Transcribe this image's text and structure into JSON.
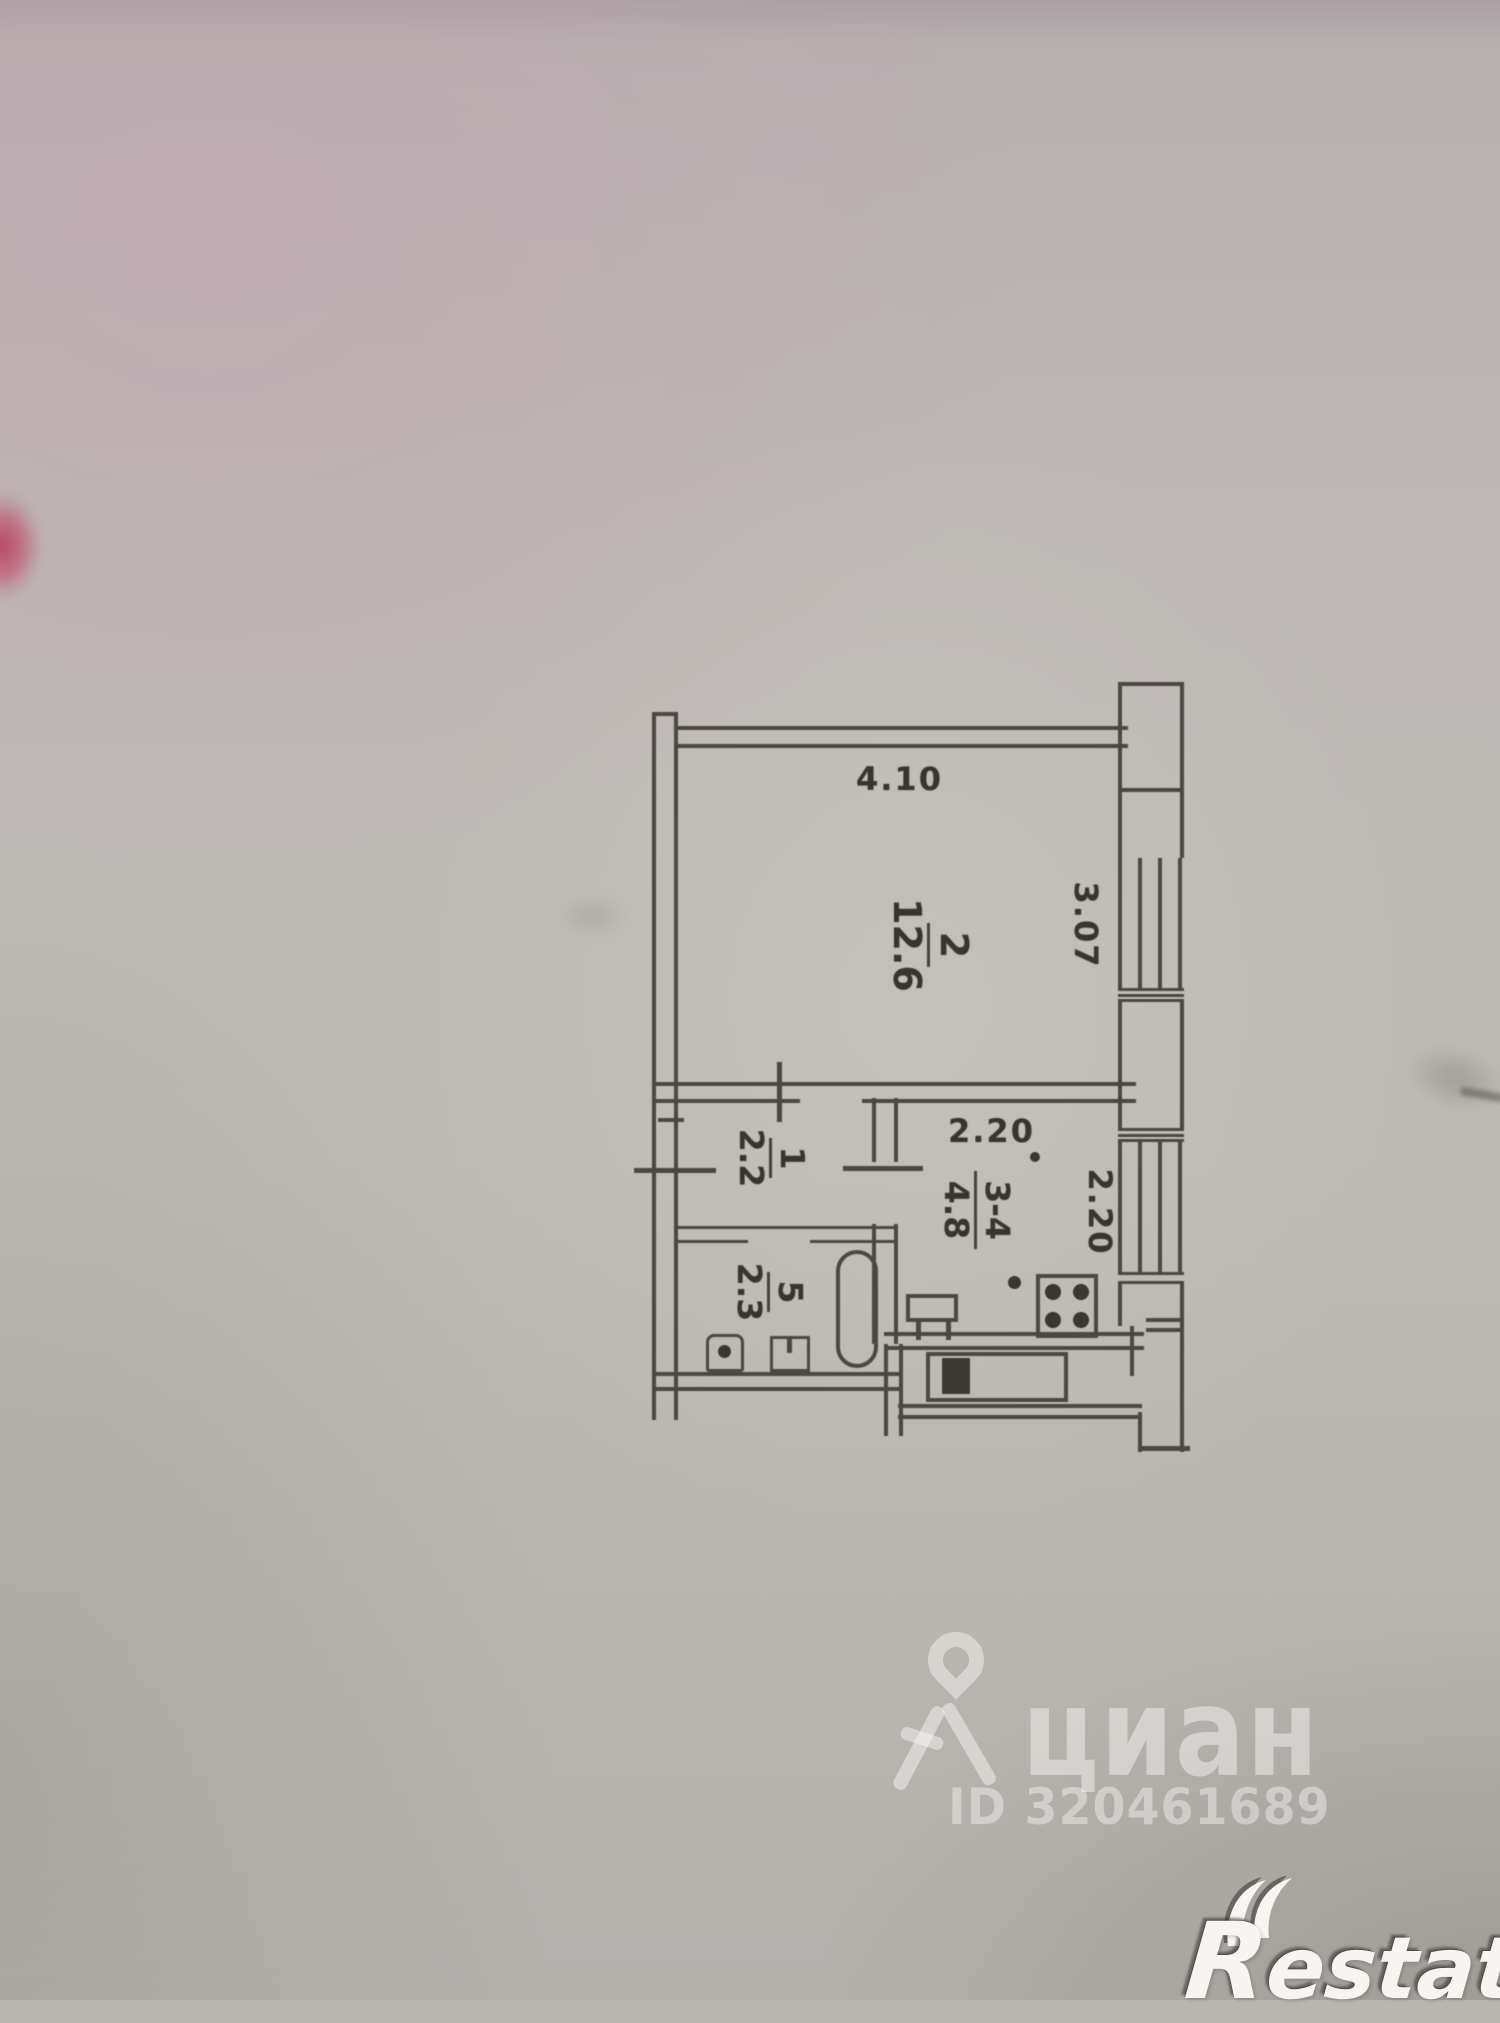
{
  "floor_plan": {
    "dimensions": {
      "top": "4.10",
      "right": "3.07",
      "kitchen_top": "2.20",
      "kitchen_right": "2.20"
    },
    "rooms": {
      "living": {
        "number": "2",
        "area": "12.6"
      },
      "hallway": {
        "number": "1",
        "area": "2.2"
      },
      "kitchen": {
        "number": "3-4",
        "area": "4.8"
      },
      "bathroom": {
        "number": "5",
        "area": "2.3"
      }
    },
    "line_color": "#4b4742"
  },
  "watermarks": {
    "cian": {
      "logo_text": "циан",
      "listing_id": "ID 320461689"
    },
    "restate": {
      "initial": "R",
      "suffix": "estate"
    }
  }
}
